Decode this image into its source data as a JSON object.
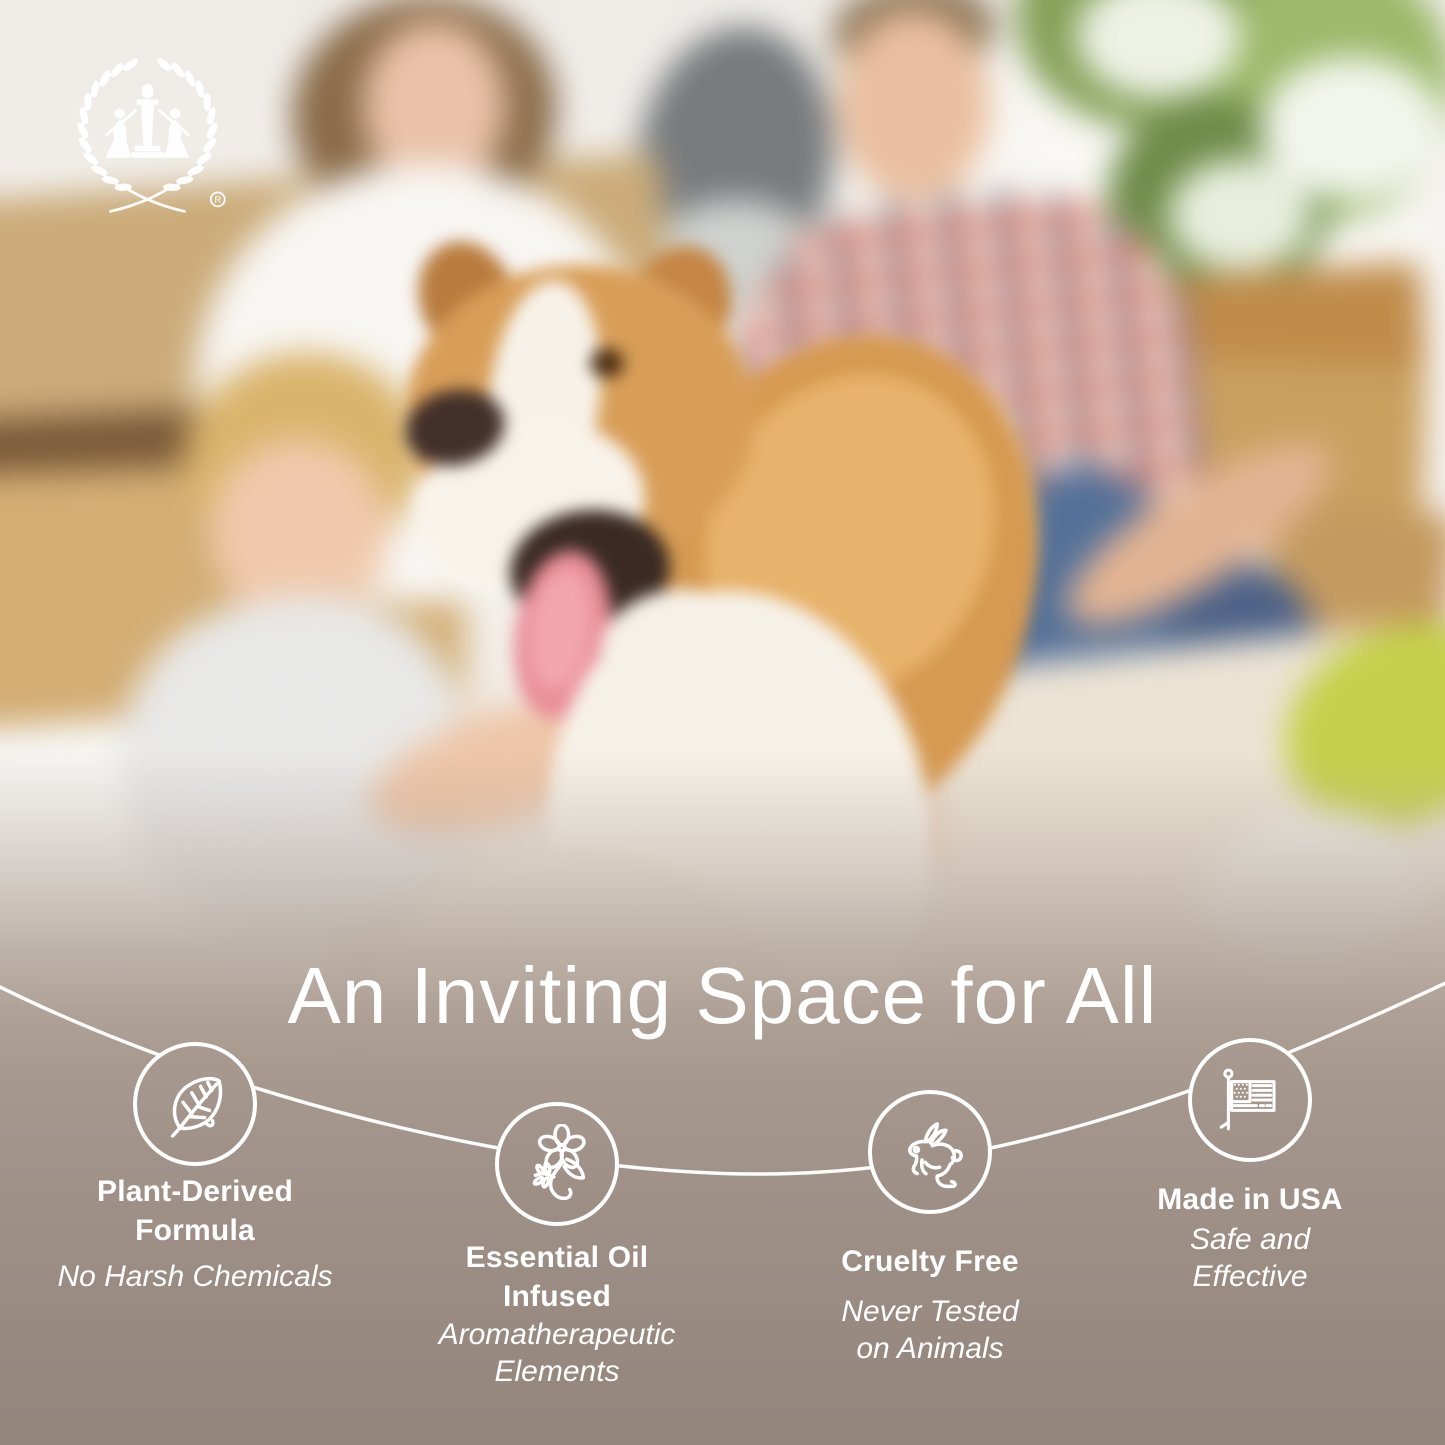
{
  "brand": {
    "logo": "laurel-wreath-with-figures-logo",
    "registered_mark": "®"
  },
  "headline": "An Inviting Space for All",
  "features": [
    {
      "icon": "leaf-icon",
      "title": "Plant-Derived\nFormula",
      "subtitle": "No Harsh Chemicals"
    },
    {
      "icon": "flower-icon",
      "title": "Essential Oil\nInfused",
      "subtitle": "Aromatherapeutic\nElements"
    },
    {
      "icon": "rabbit-icon",
      "title": "Cruelty Free",
      "subtitle": "Never Tested\non Animals"
    },
    {
      "icon": "flag-icon",
      "title": "Made in USA",
      "subtitle": "Safe and\nEffective"
    }
  ],
  "palette": {
    "overlay_taupe": "#9a8c83",
    "text": "#ffffff"
  }
}
